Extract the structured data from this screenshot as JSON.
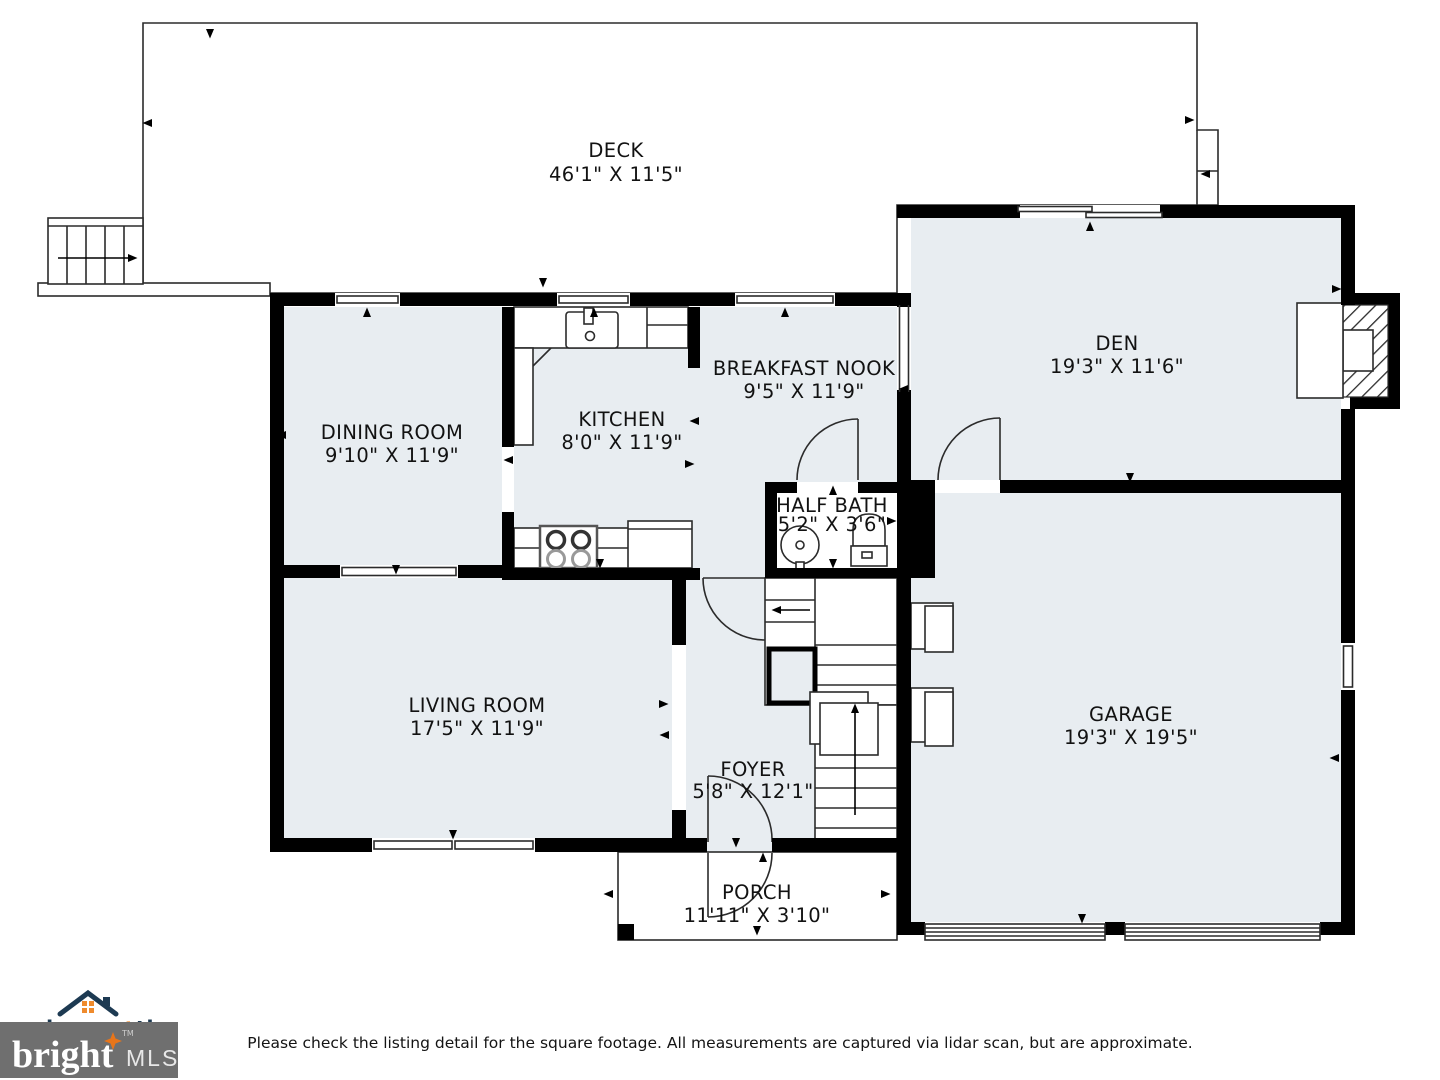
{
  "rooms": {
    "deck": {
      "name": "DECK",
      "dims": "46'1\" X 11'5\""
    },
    "den": {
      "name": "DEN",
      "dims": "19'3\" X 11'6\""
    },
    "dining": {
      "name": "DINING ROOM",
      "dims": "9'10\" X 11'9\""
    },
    "kitchen": {
      "name": "KITCHEN",
      "dims": "8'0\" X 11'9\""
    },
    "breakfast": {
      "name": "BREAKFAST NOOK",
      "dims": "9'5\" X 11'9\""
    },
    "halfbath": {
      "name": "HALF BATH",
      "dims": "5'2\" X 3'6\""
    },
    "living": {
      "name": "LIVING ROOM",
      "dims": "17'5\" X 11'9\""
    },
    "garage": {
      "name": "GARAGE",
      "dims": "19'3\" X 19'5\""
    },
    "foyer": {
      "name": "FOYER",
      "dims": "5'8\" X 12'1\""
    },
    "porch": {
      "name": "PORCH",
      "dims": "11'11\" X 3'10\""
    }
  },
  "footer": {
    "hommati": "hommati",
    "com": ".com",
    "bright": "bright",
    "tm": "TM",
    "mls": "MLS",
    "disclaimer": "Please check the listing detail for the square footage. All measurements are captured via lidar scan, but are approximate."
  },
  "colors": {
    "wall": "#000000",
    "room_fill": "#e8edf1",
    "accent_orange": "#ef8b2d",
    "logo_navy": "#1d3a52",
    "mls_box_gray": "#6f6f6f"
  }
}
